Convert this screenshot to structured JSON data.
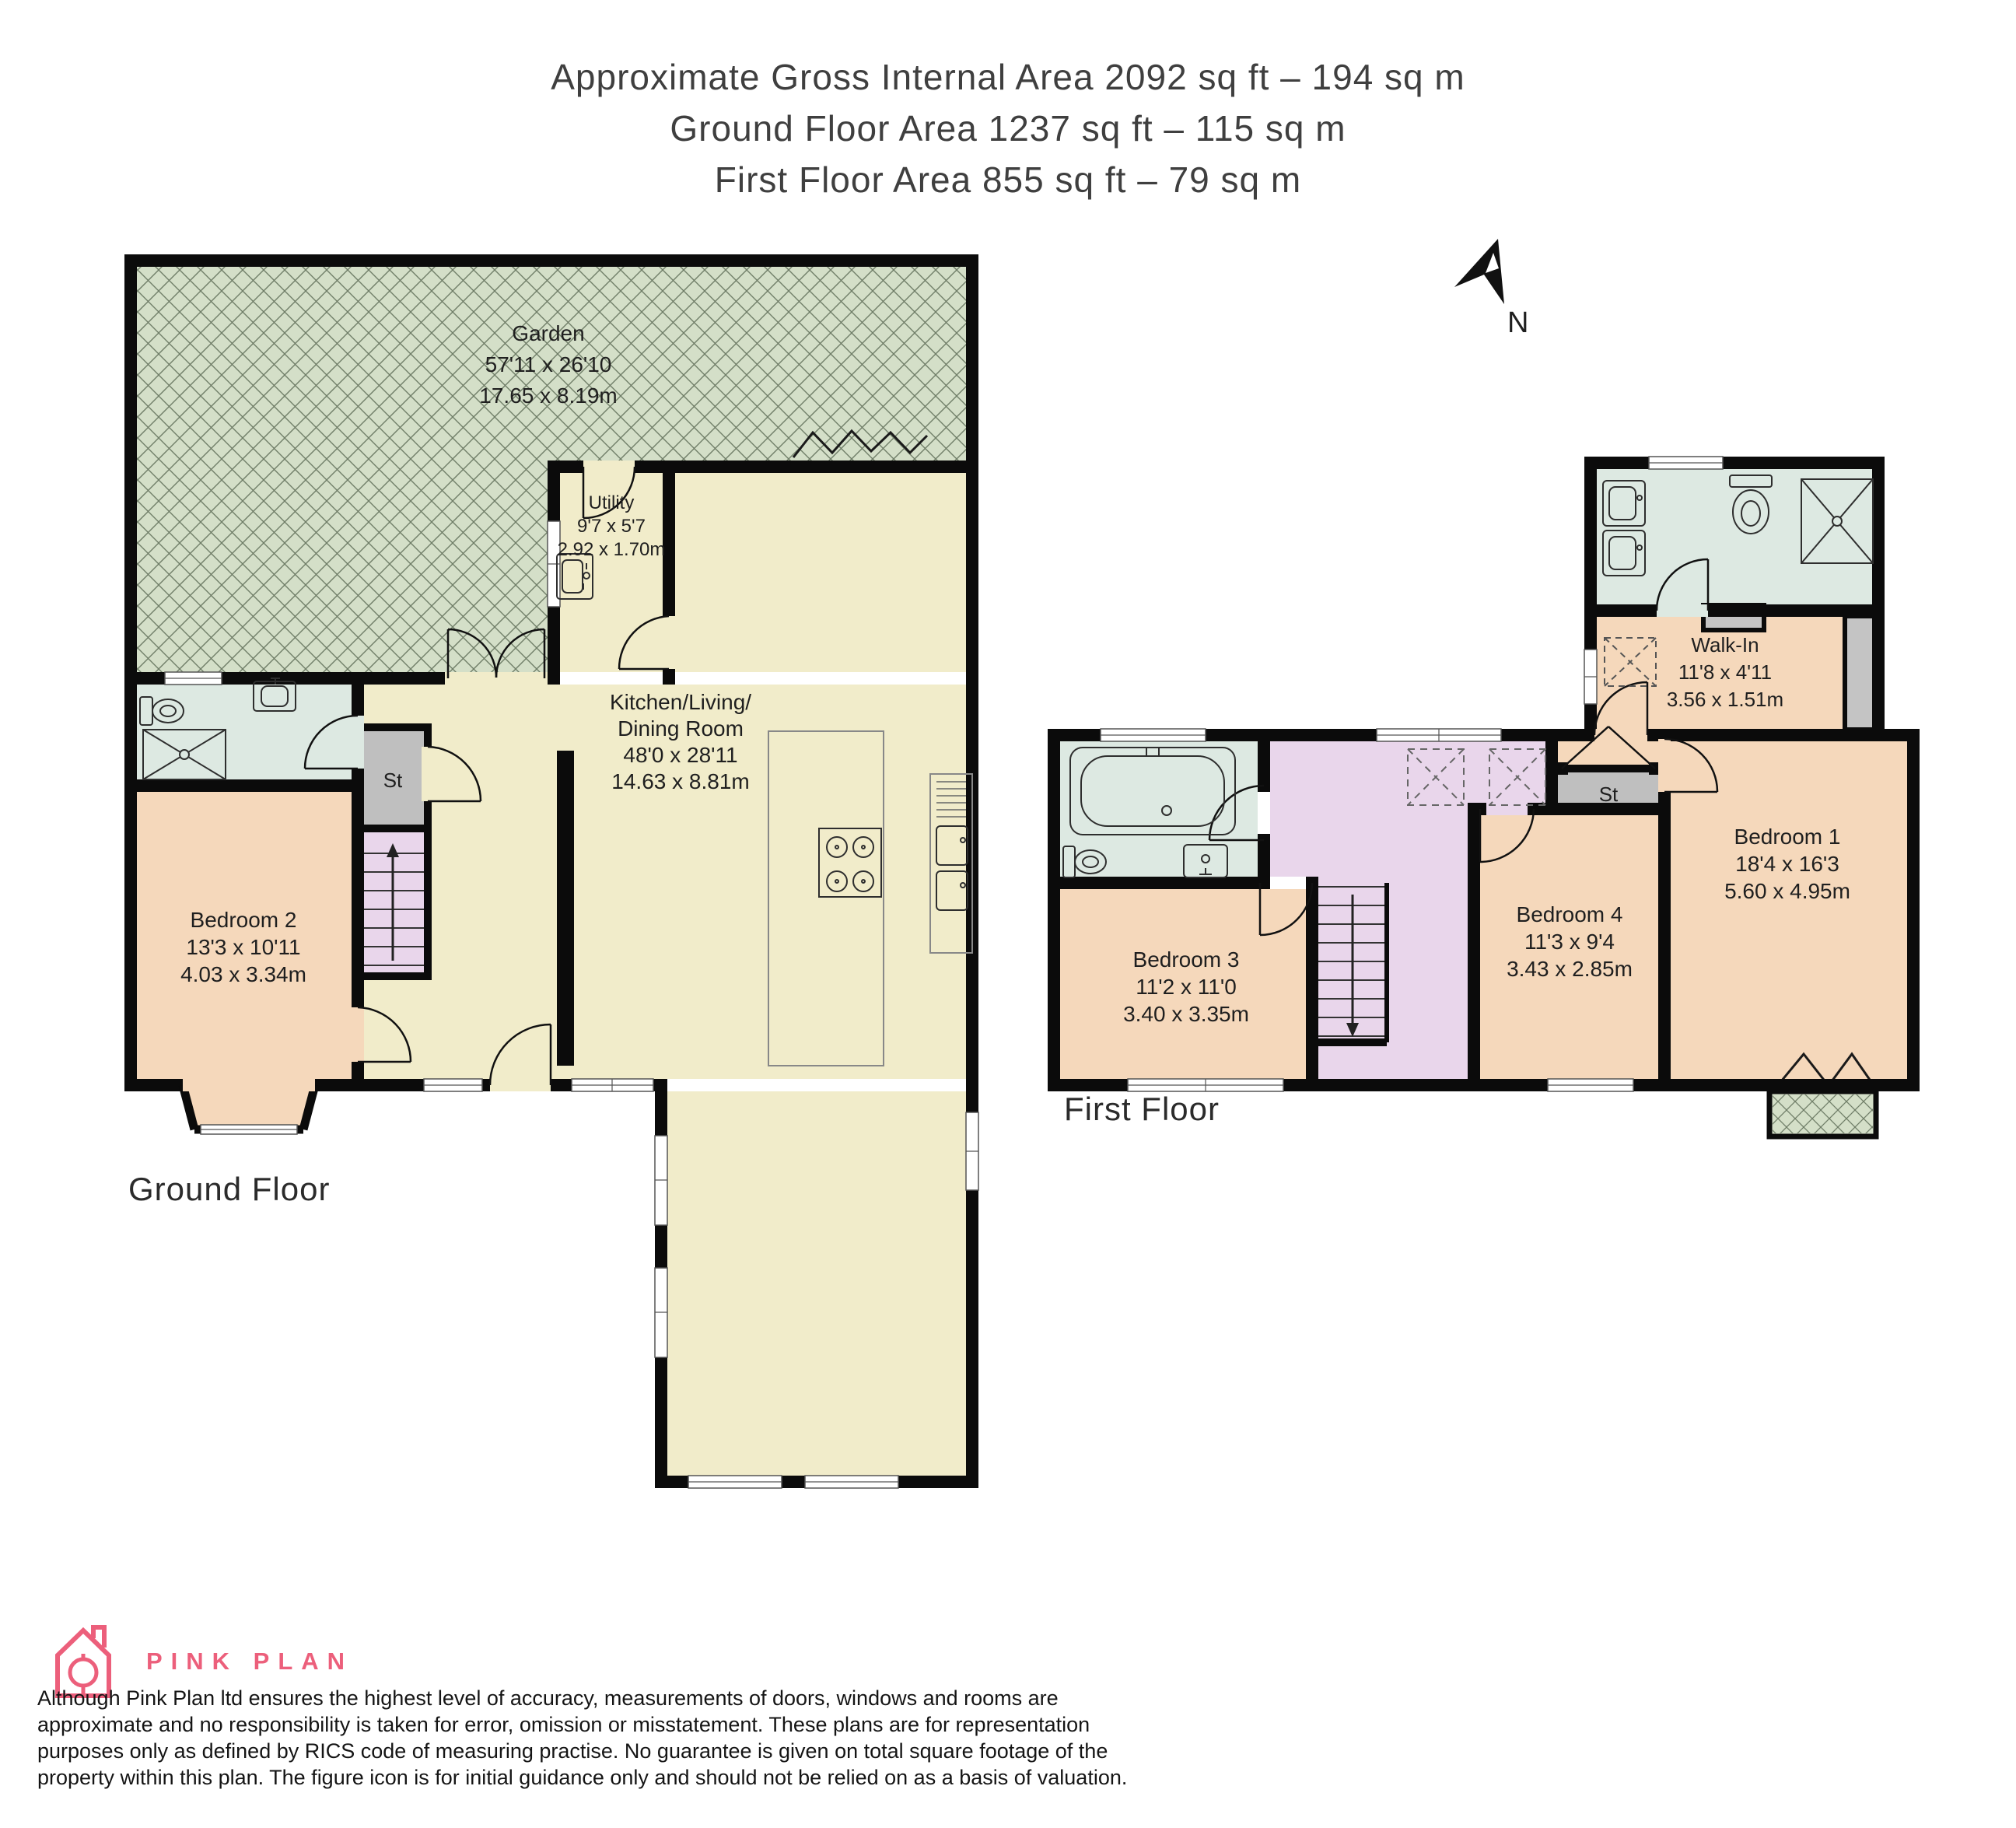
{
  "header": {
    "line1": "Approximate Gross Internal Area 2092 sq ft – 194 sq m",
    "line2": "Ground Floor Area 1237 sq ft – 115 sq m",
    "line3": "First Floor Area 855 sq ft – 79 sq m"
  },
  "compass": {
    "north_label": "N"
  },
  "ground_floor": {
    "label": "Ground Floor",
    "garden": {
      "name": "Garden",
      "imperial": "57'11 x 26'10",
      "metric": "17.65 x 8.19m"
    },
    "utility": {
      "name": "Utility",
      "imperial": "9'7 x 5'7",
      "metric": "2.92 x 1.70m"
    },
    "kitchen": {
      "name1": "Kitchen/Living/",
      "name2": "Dining Room",
      "imperial": "48'0 x 28'11",
      "metric": "14.63 x 8.81m"
    },
    "bedroom2": {
      "name": "Bedroom 2",
      "imperial": "13'3 x 10'11",
      "metric": "4.03 x 3.34m"
    },
    "store": {
      "label": "St"
    }
  },
  "first_floor": {
    "label": "First Floor",
    "walk_in": {
      "name": "Walk-In",
      "imperial": "11'8 x 4'11",
      "metric": "3.56 x 1.51m"
    },
    "bedroom1": {
      "name": "Bedroom 1",
      "imperial": "18'4 x 16'3",
      "metric": "5.60 x 4.95m"
    },
    "bedroom3": {
      "name": "Bedroom 3",
      "imperial": "11'2 x 11'0",
      "metric": "3.40 x 3.35m"
    },
    "bedroom4": {
      "name": "Bedroom 4",
      "imperial": "11'3 x 9'4",
      "metric": "3.43 x 2.85m"
    },
    "store": {
      "label": "St"
    }
  },
  "branding": {
    "logo_text": "PINK PLAN"
  },
  "disclaimer": {
    "line1": "Although Pink Plan ltd ensures the highest level of accuracy, measurements of doors, windows and rooms are",
    "line2": "approximate and no responsibility is taken for error, omission or misstatement. These plans are for representation",
    "line3": "purposes only as defined by RICS code of measuring practise. No guarantee is given on total square footage of the",
    "line4": "property within this plan. The figure icon is for initial guidance only and should not be relied on as a basis of valuation."
  },
  "colors": {
    "wall": "#0b0b0b",
    "cream": "#f1ecca",
    "peach": "#f5d8bb",
    "bath_green": "#dde9e2",
    "lilac": "#e9d6eb",
    "store_gray": "#bfbfbf",
    "garden_green": "#d4dfc8",
    "brand_pink": "#ec5f7b"
  }
}
